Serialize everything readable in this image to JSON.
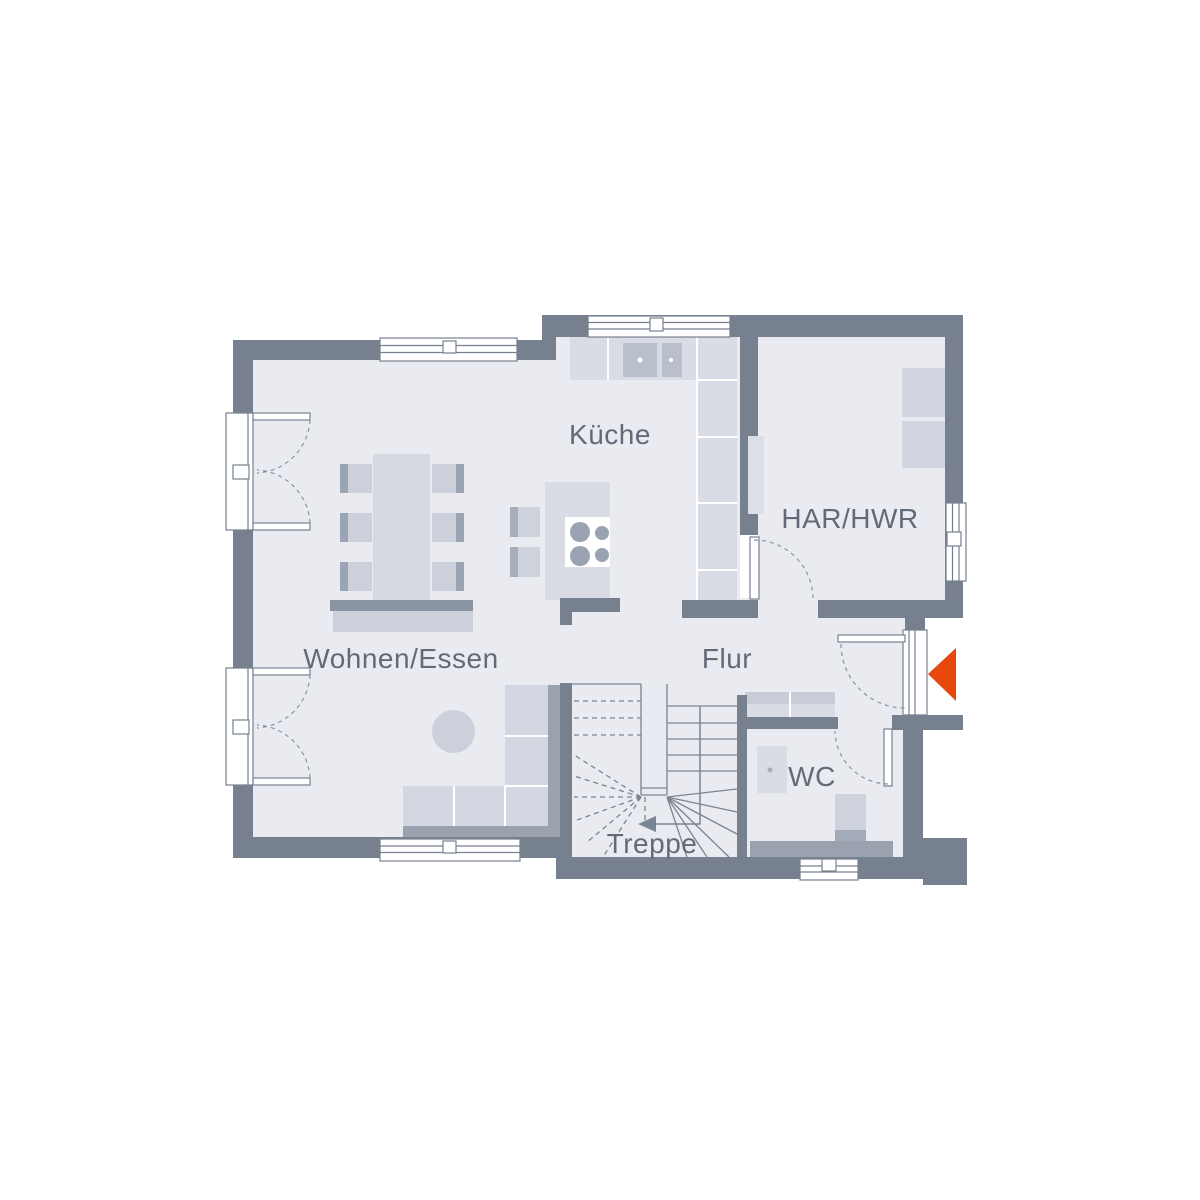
{
  "plan": {
    "type": "floor-plan",
    "background": "#ffffff",
    "colors": {
      "wall": "#76808f",
      "floor": "#e9ebf1",
      "furniture_light": "#d9dce4",
      "furniture_mid": "#ccd0da",
      "furniture_dark": "#9aa2ae",
      "chair_back": "#9ba4b2",
      "sink": "#b9c0cb",
      "stroke_line": "#7b8492",
      "label_text": "#626a78",
      "accent": "#e8470d",
      "window": "#ffffff"
    },
    "rooms": [
      {
        "id": "kueche",
        "label": "Küche"
      },
      {
        "id": "har_hwr",
        "label": "HAR/HWR"
      },
      {
        "id": "wohnen_essen",
        "label": "Wohnen/Essen"
      },
      {
        "id": "flur",
        "label": "Flur"
      },
      {
        "id": "wc",
        "label": "WC"
      },
      {
        "id": "treppe",
        "label": "Treppe"
      }
    ],
    "entrance_marker": {
      "icon": "entrance-arrow-icon",
      "color": "#e8470d",
      "direction": "left"
    }
  }
}
